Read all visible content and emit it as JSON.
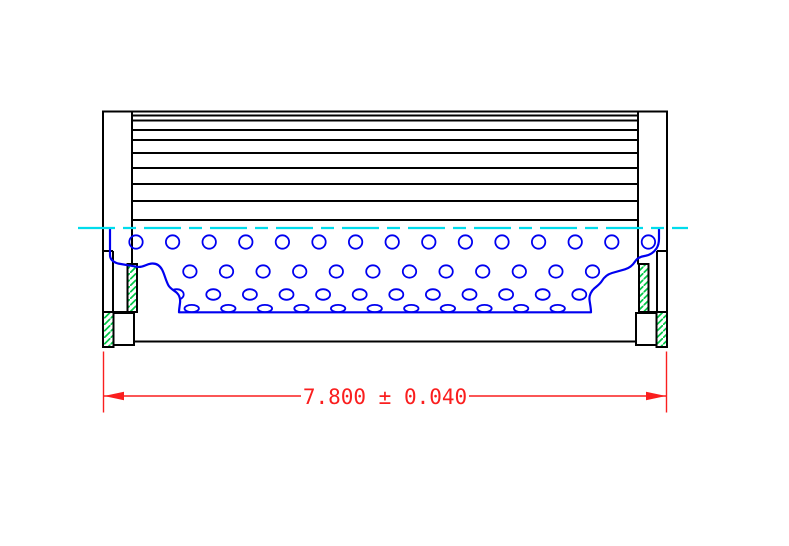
{
  "drawing": {
    "type": "technical-cross-section",
    "subject": "cartridge filter element side view with cutaway showing perforated inner core",
    "dimension": {
      "label": "7.800 ± 0.040",
      "value": "7.800",
      "plus_minus": "±",
      "tolerance": "0.040"
    },
    "colors": {
      "line": "#000000",
      "core_blue": "#0000f0",
      "centerline_cyan": "#00dcec",
      "hatch_green": "#00c846",
      "dimension_red": "#fa1e1e",
      "background": "#ffffff"
    },
    "pleats": {
      "x1": 132,
      "x2": 638,
      "ys": [
        115.5,
        120.5,
        130,
        140,
        153,
        168,
        184,
        201
      ]
    },
    "perforations": {
      "spacing_x": 36.6,
      "rows": [
        {
          "cy": 242,
          "rx": 6.7,
          "ry": 6.7,
          "start_x": 136,
          "count": 15
        },
        {
          "cy": 271.5,
          "rx": 6.7,
          "ry": 6.2,
          "start_x": 153.3,
          "count": 13
        },
        {
          "cy": 294.5,
          "rx": 7.0,
          "ry": 5.3,
          "start_x": 176.7,
          "count": 12
        },
        {
          "cy": 308.5,
          "rx": 7.2,
          "ry": 3.6,
          "start_x": 191.7,
          "count": 11
        }
      ]
    },
    "centerline": {
      "y": 228,
      "x1": 78,
      "x2": 688,
      "dash": "37 8 13 8"
    }
  }
}
